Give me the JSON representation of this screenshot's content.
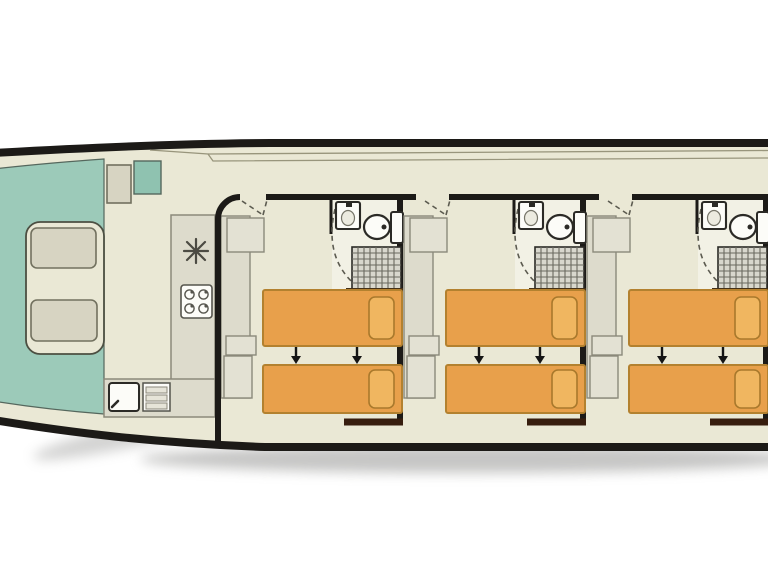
{
  "meta": {
    "type": "boat-deck-plan",
    "description": "Top-down floor plan of a houseboat: open bow seating deck (left), saloon with galley, and three identical en-suite cabins with twin single beds. Stern is cut off at the right edge of the image.",
    "orientation": "bow-left"
  },
  "colors": {
    "bg": "#ffffff",
    "floor": "#eae8d5",
    "bathfloor": "#f2f1e5",
    "teal": "#9ccab9",
    "teal2": "#8fc2b0",
    "tealline": "#55675d",
    "seat": "#d7d4c2",
    "seatline": "#72715f",
    "benchline": "#4c4f42",
    "cabinet": "#dddbcc",
    "cabinet2": "#e3e1d3",
    "cabinetline": "#8b897b",
    "white": "#fcfcf8",
    "dark": "#2b2a26",
    "wall": "#1c1a17",
    "wallbrown": "#371d0e",
    "shelf": "#453118",
    "bed": "#e8a04b",
    "bedline": "#b3812f",
    "pillow": "#f0b660",
    "pillowline": "#a9792c",
    "showerbg": "#d8d7cd",
    "showerline": "#6a695f",
    "dashline": "#5c5b50",
    "roofline": "#98957c",
    "shadow": "#8d8d8b"
  },
  "bow_deck": {
    "name": "bow-seating-deck",
    "floor": "teal",
    "bench": "u-shaped-bench",
    "cushions": 2,
    "helm_seat": 1,
    "step_box": 1
  },
  "galley": {
    "name": "galley",
    "fixtures": [
      "fridge",
      "hob-4-burner",
      "sink",
      "drawer-unit"
    ]
  },
  "cabins": [
    {
      "id": "cabin-1",
      "offset_x": 0,
      "left_wall": "rounded",
      "beds": 2,
      "bed_type": "twin-singles",
      "arrows": "slide-together",
      "wardrobe": true,
      "bathroom": [
        "washbasin",
        "toilet",
        "shower"
      ]
    },
    {
      "id": "cabin-2",
      "offset_x": 183,
      "left_wall": "stub",
      "beds": 2,
      "bed_type": "twin-singles",
      "arrows": "slide-together",
      "wardrobe": true,
      "bathroom": [
        "washbasin",
        "toilet",
        "shower"
      ]
    },
    {
      "id": "cabin-3",
      "offset_x": 366,
      "left_wall": "stub",
      "beds": 2,
      "bed_type": "twin-singles",
      "arrows": "slide-together",
      "wardrobe": true,
      "bathroom": [
        "washbasin",
        "toilet",
        "shower"
      ]
    }
  ],
  "icons": {
    "fridge-icon": "snowflake",
    "hob-icon": "four burner circles",
    "sink-icon": "square basin with tap",
    "galley-sink-icon": "square basin with corner tap",
    "toilet-icon": "oval bowl with cistern",
    "shower-icon": "hatched grid square",
    "bed-arrow-icon": "small down arrow",
    "door-swing-icon": "dashed arc"
  }
}
